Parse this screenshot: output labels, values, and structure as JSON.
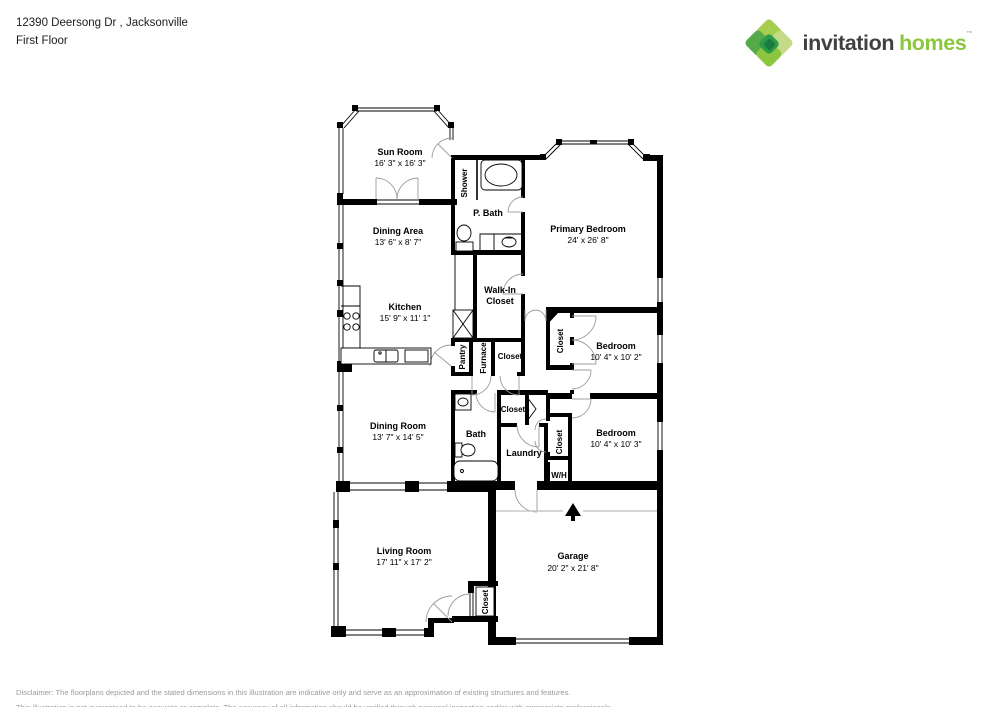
{
  "header": {
    "address": "12390 Deersong Dr , Jacksonville",
    "floor": "First Floor"
  },
  "brand": {
    "word1": "invitation",
    "word2": "homes",
    "tm": "™",
    "logo_green": "#8cc63f",
    "logo_dark": "#414042",
    "diamond_colors": [
      "#a7cd50",
      "#c3da87",
      "#54a948",
      "#8cc63f",
      "#2e9b48",
      "#1b7a40"
    ]
  },
  "rooms": {
    "sun_room": {
      "name": "Sun Room",
      "dims": "16' 3\" x 16' 3\""
    },
    "dining_area": {
      "name": "Dining Area",
      "dims": "13' 6\" x 8' 7\""
    },
    "kitchen": {
      "name": "Kitchen",
      "dims": "15' 9\" x 11' 1\""
    },
    "shower": {
      "name": "Shower"
    },
    "p_bath": {
      "name": "P. Bath"
    },
    "walk_in_closet": {
      "line1": "Walk-In",
      "line2": "Closet"
    },
    "pantry": {
      "name": "Pantry"
    },
    "furnace": {
      "name": "Furnace"
    },
    "closet_hall": {
      "name": "Closet"
    },
    "primary_bedroom": {
      "name": "Primary Bedroom",
      "dims": "24' x 26' 8\""
    },
    "closet_bed1": {
      "name": "Closet"
    },
    "bedroom1": {
      "name": "Bedroom",
      "dims": "10' 4\" x 10' 2\""
    },
    "dining_room": {
      "name": "Dining Room",
      "dims": "13' 7\" x 14' 5\""
    },
    "bath": {
      "name": "Bath"
    },
    "closet_bath": {
      "name": "Closet"
    },
    "laundry": {
      "name": "Laundry"
    },
    "closet_bed2": {
      "name": "Closet"
    },
    "wh": {
      "name": "W/H"
    },
    "bedroom2": {
      "name": "Bedroom",
      "dims": "10' 4\" x 10' 3\""
    },
    "living_room": {
      "name": "Living Room",
      "dims": "17' 11\" x 17' 2\""
    },
    "garage": {
      "name": "Garage",
      "dims": "20' 2\" x 21' 8\""
    },
    "closet_entry": {
      "name": "Closet"
    }
  },
  "footer": {
    "line1": "Disclaimer: The floorplans depicted and the stated dimensions in this illustration are indicative only and serve as an approximation of existing structures and features.",
    "line2": "This illustration is not guaranteed to be accurate or complete. The accuracy of all information should be verified through personal inspection and/or with appropriate professionals."
  }
}
